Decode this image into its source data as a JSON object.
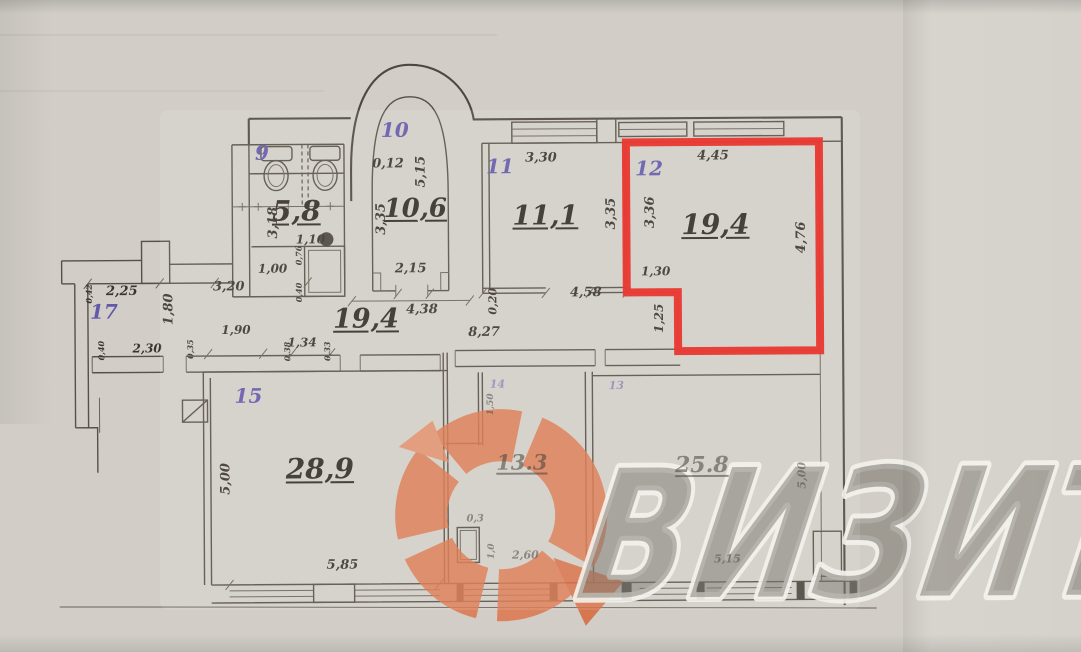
{
  "watermark": {
    "text": "ВИЗИТ",
    "logo_color": "#dd7347",
    "text_fill": "rgba(108,103,95,0.50)",
    "text_outline": "rgba(244,242,236,0.90)"
  },
  "highlight": {
    "color": "#e8231b",
    "room_number": "12",
    "room_area": "19,4"
  },
  "rooms": [
    {
      "number": "9"
    },
    {
      "number": "10",
      "area_m2": "10,6"
    },
    {
      "number": "11",
      "area_m2": "11,1"
    },
    {
      "number": "12",
      "area_m2": "19,4",
      "highlighted": true
    },
    {
      "number": "13",
      "area_m2": "13.3"
    },
    {
      "number": "14"
    },
    {
      "number": "15",
      "area_m2": "28,9"
    },
    {
      "number": "17",
      "area_m2": "19,4"
    },
    {
      "area_m2": "5,8"
    },
    {
      "area_m2": "25.8"
    }
  ],
  "plan_labels": [
    {
      "text": "9",
      "x": 263,
      "y": 151,
      "size": 20,
      "kind": "room-number"
    },
    {
      "text": "10",
      "x": 396,
      "y": 129,
      "size": 20,
      "kind": "room-number"
    },
    {
      "text": "11",
      "x": 501,
      "y": 166,
      "size": 20,
      "kind": "room-number"
    },
    {
      "text": "12",
      "x": 650,
      "y": 169,
      "size": 20,
      "kind": "room-number"
    },
    {
      "text": "15",
      "x": 248,
      "y": 394,
      "size": 20,
      "kind": "room-number"
    },
    {
      "text": "17",
      "x": 104,
      "y": 309,
      "size": 20,
      "kind": "room-number"
    },
    {
      "text": "14",
      "x": 497,
      "y": 384,
      "size": 11,
      "kind": "room-number",
      "faint": true
    },
    {
      "text": "13",
      "x": 616,
      "y": 386,
      "size": 11,
      "kind": "room-number",
      "faint": true
    },
    {
      "text": "5,8",
      "x": 297,
      "y": 210,
      "size": 28,
      "kind": "area"
    },
    {
      "text": "10,6",
      "x": 416,
      "y": 208,
      "size": 26,
      "kind": "area"
    },
    {
      "text": "11,1",
      "x": 546,
      "y": 216,
      "size": 27,
      "kind": "area"
    },
    {
      "text": "19,4",
      "x": 716,
      "y": 226,
      "size": 28,
      "kind": "area"
    },
    {
      "text": "19,4",
      "x": 366,
      "y": 318,
      "size": 27,
      "kind": "area"
    },
    {
      "text": "28,9",
      "x": 319,
      "y": 468,
      "size": 28,
      "kind": "area"
    },
    {
      "text": "13.3",
      "x": 521,
      "y": 462,
      "size": 21,
      "kind": "area",
      "faint": true
    },
    {
      "text": "25.8",
      "x": 701,
      "y": 466,
      "size": 22,
      "kind": "area",
      "faint": true
    },
    {
      "text": "0,12",
      "x": 389,
      "y": 163,
      "size": 13,
      "kind": "dimension"
    },
    {
      "text": "5,15",
      "x": 422,
      "y": 171,
      "size": 13,
      "kind": "dimension",
      "rot": 1
    },
    {
      "text": "3,35",
      "x": 382,
      "y": 218,
      "size": 13,
      "kind": "dimension",
      "rot": 1
    },
    {
      "text": "2,15",
      "x": 411,
      "y": 268,
      "size": 13,
      "kind": "dimension"
    },
    {
      "text": "3,18",
      "x": 274,
      "y": 221,
      "size": 13,
      "kind": "dimension",
      "rot": 1
    },
    {
      "text": "1,10",
      "x": 311,
      "y": 238,
      "size": 12,
      "kind": "dimension"
    },
    {
      "text": "0,76",
      "x": 299,
      "y": 254,
      "size": 8,
      "kind": "dimension",
      "rot": 1
    },
    {
      "text": "0,40",
      "x": 299,
      "y": 291,
      "size": 8,
      "kind": "dimension",
      "rot": 1
    },
    {
      "text": "1,00",
      "x": 273,
      "y": 267,
      "size": 12,
      "kind": "dimension"
    },
    {
      "text": "3,30",
      "x": 542,
      "y": 158,
      "size": 13,
      "kind": "dimension"
    },
    {
      "text": "3,35",
      "x": 612,
      "y": 214,
      "size": 13,
      "kind": "dimension",
      "rot": 1
    },
    {
      "text": "4,45",
      "x": 714,
      "y": 157,
      "size": 13,
      "kind": "dimension"
    },
    {
      "text": "3,36",
      "x": 651,
      "y": 213,
      "size": 13,
      "kind": "dimension",
      "rot": 1
    },
    {
      "text": "4,76",
      "x": 802,
      "y": 239,
      "size": 13,
      "kind": "dimension",
      "rot": 1
    },
    {
      "text": "1,30",
      "x": 656,
      "y": 272,
      "size": 12,
      "kind": "dimension"
    },
    {
      "text": "1,25",
      "x": 659,
      "y": 319,
      "size": 12,
      "kind": "dimension",
      "rot": 1
    },
    {
      "text": "4,58",
      "x": 586,
      "y": 293,
      "size": 13,
      "kind": "dimension"
    },
    {
      "text": "0,20",
      "x": 493,
      "y": 301,
      "size": 11,
      "kind": "dimension",
      "rot": 1
    },
    {
      "text": "8,27",
      "x": 484,
      "y": 332,
      "size": 13,
      "kind": "dimension"
    },
    {
      "text": "2,25",
      "x": 122,
      "y": 289,
      "size": 13,
      "kind": "dimension"
    },
    {
      "text": "1,80",
      "x": 169,
      "y": 307,
      "size": 13,
      "kind": "dimension",
      "rot": 1
    },
    {
      "text": "3,20",
      "x": 229,
      "y": 285,
      "size": 13,
      "kind": "dimension"
    },
    {
      "text": "1,90",
      "x": 236,
      "y": 328,
      "size": 12,
      "kind": "dimension"
    },
    {
      "text": "2,30",
      "x": 147,
      "y": 346,
      "size": 12,
      "kind": "dimension"
    },
    {
      "text": "1,34",
      "x": 302,
      "y": 341,
      "size": 12,
      "kind": "dimension"
    },
    {
      "text": "0,42",
      "x": 89,
      "y": 291,
      "size": 8,
      "kind": "dimension",
      "rot": 1
    },
    {
      "text": "0,40",
      "x": 101,
      "y": 348,
      "size": 8,
      "kind": "dimension",
      "rot": 1
    },
    {
      "text": "0,35",
      "x": 190,
      "y": 347,
      "size": 8,
      "kind": "dimension",
      "rot": 1
    },
    {
      "text": "0,38",
      "x": 287,
      "y": 350,
      "size": 8,
      "kind": "dimension",
      "rot": 1
    },
    {
      "text": "0,33",
      "x": 327,
      "y": 350,
      "size": 8,
      "kind": "dimension",
      "rot": 1
    },
    {
      "text": "4,38",
      "x": 422,
      "y": 309,
      "size": 13,
      "kind": "dimension"
    },
    {
      "text": "5,00",
      "x": 225,
      "y": 477,
      "size": 13,
      "kind": "dimension",
      "rot": 1
    },
    {
      "text": "5,85",
      "x": 341,
      "y": 564,
      "size": 13,
      "kind": "dimension"
    },
    {
      "text": "0,3",
      "x": 474,
      "y": 519,
      "size": 10,
      "kind": "dimension",
      "faint": true
    },
    {
      "text": "2,60",
      "x": 524,
      "y": 555,
      "size": 11,
      "kind": "dimension",
      "faint": true
    },
    {
      "text": "1,50",
      "x": 491,
      "y": 404,
      "size": 9,
      "kind": "dimension",
      "rot": 1,
      "faint": true
    },
    {
      "text": "1,0",
      "x": 491,
      "y": 551,
      "size": 9,
      "kind": "dimension",
      "rot": 1,
      "faint": true
    },
    {
      "text": "5,15",
      "x": 726,
      "y": 560,
      "size": 11,
      "kind": "dimension",
      "faint": true
    },
    {
      "text": "5,00",
      "x": 801,
      "y": 477,
      "size": 11,
      "kind": "dimension",
      "rot": 1,
      "faint": true
    }
  ]
}
